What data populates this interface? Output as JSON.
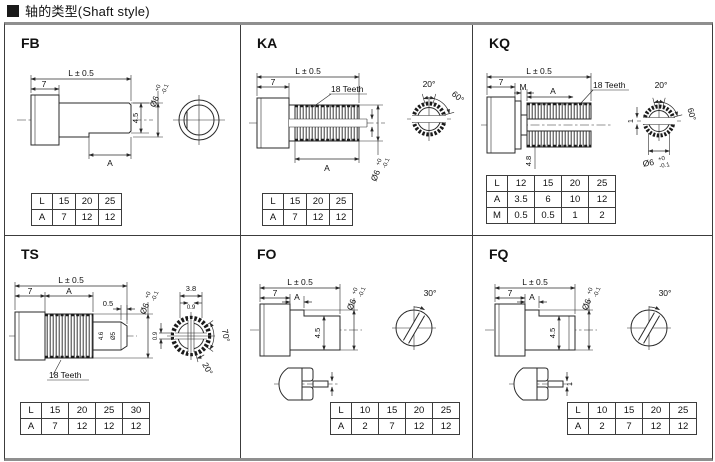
{
  "page": {
    "title": "轴的类型(Shaft style)"
  },
  "panels": [
    {
      "id": "FB",
      "label": "FB",
      "dims": {
        "len": "L ± 0.5",
        "seg7": "7",
        "h45": "4.5",
        "segA": "A",
        "dia": "Ø6",
        "tolTop": "+0",
        "tolBot": "-0.1"
      },
      "table": {
        "rows": [
          [
            "L",
            "15",
            "20",
            "25"
          ],
          [
            "A",
            "7",
            "12",
            "12"
          ]
        ]
      }
    },
    {
      "id": "KA",
      "label": "KA",
      "dims": {
        "len": "L ± 0.5",
        "seg7": "7",
        "teeth": "18 Teeth",
        "segA": "A",
        "a20": "20°",
        "a60": "60°",
        "dia": "Ø6",
        "tolTop": "+0",
        "tolBot": "-0.1"
      },
      "table": {
        "rows": [
          [
            "L",
            "15",
            "20",
            "25"
          ],
          [
            "A",
            "7",
            "12",
            "12"
          ]
        ]
      }
    },
    {
      "id": "KQ",
      "label": "KQ",
      "dims": {
        "len": "L ± 0.5",
        "seg7": "7",
        "segM": "M",
        "segA": "A",
        "teeth": "18 Teeth",
        "h48": "4.8",
        "slot1": "1",
        "a20": "20°",
        "a60": "60°",
        "dia": "Ø6",
        "tolTop": "+0",
        "tolBot": "-0.1"
      },
      "table": {
        "rows": [
          [
            "L",
            "12",
            "15",
            "20",
            "25"
          ],
          [
            "A",
            "3.5",
            "6",
            "10",
            "12"
          ],
          [
            "M",
            "0.5",
            "0.5",
            "1",
            "2"
          ]
        ]
      }
    },
    {
      "id": "TS",
      "label": "TS",
      "dims": {
        "len": "L ± 0.5",
        "seg7": "7",
        "segA": "A",
        "cham": "0.5",
        "h46": "4.6",
        "dia5": "Ø5",
        "teeth": "18 Teeth",
        "w38": "3.8",
        "s09a": "0.9",
        "s09b": "0.9",
        "a70": "70°",
        "a20": "20°",
        "dia": "Ø6",
        "tolTop": "+0",
        "tolBot": "-0.1"
      },
      "table": {
        "rows": [
          [
            "L",
            "15",
            "20",
            "25",
            "30"
          ],
          [
            "A",
            "7",
            "12",
            "12",
            "12"
          ]
        ]
      }
    },
    {
      "id": "FO",
      "label": "FO",
      "dims": {
        "len": "L ± 0.5",
        "seg7": "7",
        "segA": "A",
        "h45": "4.5",
        "a30": "30°",
        "dia": "Ø6",
        "tolTop": "+0",
        "tolBot": "-0.1"
      },
      "table": {
        "rows": [
          [
            "L",
            "10",
            "15",
            "20",
            "25"
          ],
          [
            "A",
            "2",
            "7",
            "12",
            "12"
          ]
        ]
      }
    },
    {
      "id": "FQ",
      "label": "FQ",
      "dims": {
        "len": "L ± 0.5",
        "seg7": "7",
        "segA": "A",
        "h45": "4.5",
        "a30": "30°",
        "slot1": "1",
        "dia": "Ø6",
        "tolTop": "+0",
        "tolBot": "-0.1"
      },
      "table": {
        "rows": [
          [
            "L",
            "10",
            "15",
            "20",
            "25"
          ],
          [
            "A",
            "2",
            "7",
            "12",
            "12"
          ]
        ]
      }
    }
  ]
}
